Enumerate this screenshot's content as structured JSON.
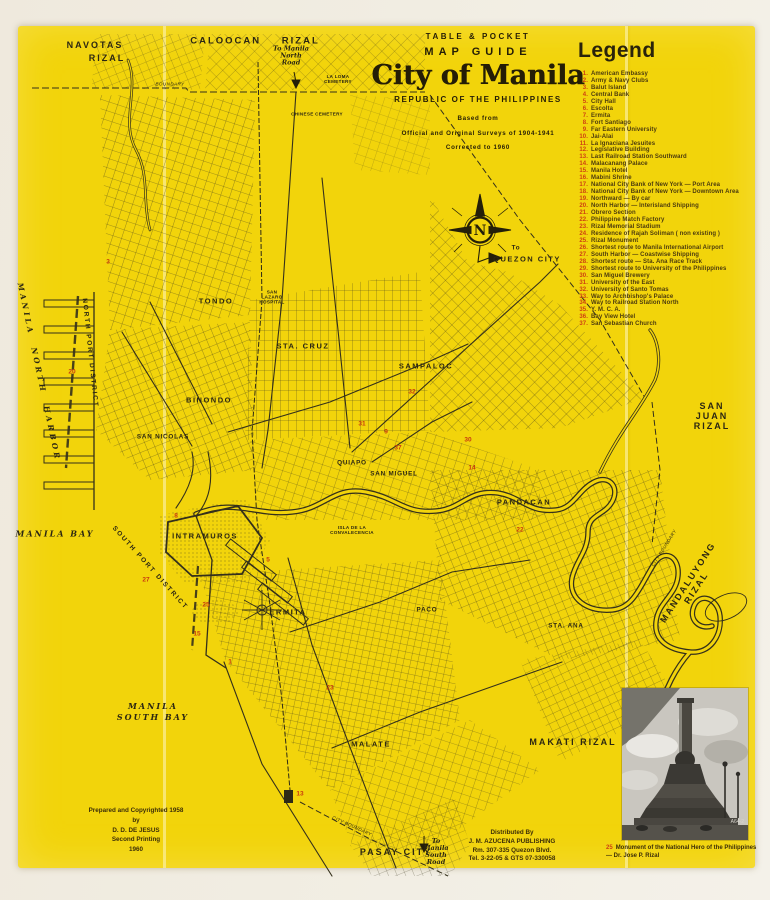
{
  "colors": {
    "sheet_yellow": "#f2d40b",
    "paper_cream": "#f1ede2",
    "ink": "#2c2712",
    "legend_number_red": "#ce4012",
    "marker_red": "#c83a10"
  },
  "title_block": {
    "line1": "TABLE & POCKET",
    "line2": "MAP GUIDE",
    "line3": "City of Manila",
    "line4": "REPUBLIC OF THE PHILIPPINES",
    "line5": "Based from",
    "line6": "Official and Original Surveys of 1904-1941",
    "line7": "Corrected to 1960"
  },
  "legend": {
    "heading": "Legend",
    "items": [
      {
        "n": "1",
        "t": "American Embassy"
      },
      {
        "n": "2",
        "t": "Army & Navy Clubs"
      },
      {
        "n": "3",
        "t": "Balut Island"
      },
      {
        "n": "4",
        "t": "Central Bank"
      },
      {
        "n": "5",
        "t": "City Hall"
      },
      {
        "n": "6",
        "t": "Escolta"
      },
      {
        "n": "7",
        "t": "Ermita"
      },
      {
        "n": "8",
        "t": "Fort Santiago"
      },
      {
        "n": "9",
        "t": "Far Eastern University"
      },
      {
        "n": "10",
        "t": "Jai-Alai"
      },
      {
        "n": "11",
        "t": "La Ignaciana Jesuites"
      },
      {
        "n": "12",
        "t": "Legislative Building"
      },
      {
        "n": "13",
        "t": "Last Railroad Station Southward"
      },
      {
        "n": "14",
        "t": "Malacanang Palace"
      },
      {
        "n": "15",
        "t": "Manila Hotel"
      },
      {
        "n": "16",
        "t": "Mabini Shrine"
      },
      {
        "n": "17",
        "t": "National City Bank of New York — Port Area"
      },
      {
        "n": "18",
        "t": "National City Bank of New York — Downtown Area"
      },
      {
        "n": "19",
        "t": "Northward — By car"
      },
      {
        "n": "20",
        "t": "North Harbor — Interisland Shipping"
      },
      {
        "n": "21",
        "t": "Obrero Section"
      },
      {
        "n": "22",
        "t": "Philippine Match Factory"
      },
      {
        "n": "23",
        "t": "Rizal Memorial Stadium"
      },
      {
        "n": "24",
        "t": "Residence of Rajah Soliman ( non existing )"
      },
      {
        "n": "25",
        "t": "Rizal Monument"
      },
      {
        "n": "26",
        "t": "Shortest route to Manila International Airport"
      },
      {
        "n": "27",
        "t": "South Harbor — Coastwise Shipping"
      },
      {
        "n": "28",
        "t": "Shortest route — Sta. Ana Race Track"
      },
      {
        "n": "29",
        "t": "Shortest route to University of the Philippines"
      },
      {
        "n": "30",
        "t": "San Miguel Brewery"
      },
      {
        "n": "31",
        "t": "University of the East"
      },
      {
        "n": "32",
        "t": "University of Santo Tomas"
      },
      {
        "n": "33",
        "t": "Way to Archbishop's Palace"
      },
      {
        "n": "34",
        "t": "Way to Railroad Station North"
      },
      {
        "n": "35",
        "t": "Y. M. C. A."
      },
      {
        "n": "36",
        "t": "Bay View Hotel"
      },
      {
        "n": "37",
        "t": "San Sebastian Church"
      }
    ]
  },
  "map": {
    "labels": [
      {
        "id": "label-navotas",
        "t": "NAVOTAS",
        "x": 95,
        "y": 45,
        "c": "town"
      },
      {
        "id": "label-navotas-rizal",
        "t": "RIZAL",
        "x": 107,
        "y": 58,
        "c": "town"
      },
      {
        "id": "label-caloocan-rizal",
        "t": "CALOOCAN RIZAL",
        "x": 255,
        "y": 41,
        "c": "townsp"
      },
      {
        "id": "label-to-manila-north-road",
        "t": "To Manila\nNorth\nRoad",
        "x": 291,
        "y": 56,
        "c": "script"
      },
      {
        "id": "label-boundary",
        "t": "BOUNDARY",
        "x": 170,
        "y": 84,
        "c": "tiny-it"
      },
      {
        "id": "label-la-loma-cemetery",
        "t": "LA LOMA\nCEMETERY",
        "x": 338,
        "y": 79,
        "c": "tinyl"
      },
      {
        "id": "label-chinese-cemetery",
        "t": "CHINESE CEMETERY",
        "x": 317,
        "y": 114,
        "c": "tinyl"
      },
      {
        "id": "label-to-quezon-city",
        "t": "To",
        "x": 516,
        "y": 248,
        "c": "dist-sm"
      },
      {
        "id": "label-quezon-city",
        "t": "QUEZON  CITY",
        "x": 527,
        "y": 259,
        "c": "dist"
      },
      {
        "id": "label-manila-north-harbor",
        "t": "MANILA  NORTH  HARBOR",
        "x": 39,
        "y": 372,
        "c": "harb",
        "r": 78
      },
      {
        "id": "label-north-port-district",
        "t": "NORTH  PORT  DISTRICT",
        "x": 90,
        "y": 353,
        "c": "port",
        "r": 84
      },
      {
        "id": "label-tondo",
        "t": "TONDO",
        "x": 216,
        "y": 301,
        "c": "dist"
      },
      {
        "id": "label-san-lazaro-hospital",
        "t": "SAN\nLAZARO\nHOSPITAL",
        "x": 272,
        "y": 297,
        "c": "tinyl"
      },
      {
        "id": "label-sta-cruz",
        "t": "STA. CRUZ",
        "x": 303,
        "y": 346,
        "c": "dist"
      },
      {
        "id": "label-sampaloc",
        "t": "SAMPALOC",
        "x": 426,
        "y": 366,
        "c": "dist"
      },
      {
        "id": "label-binondo",
        "t": "BINONDO",
        "x": 209,
        "y": 400,
        "c": "dist"
      },
      {
        "id": "label-san-nicolas",
        "t": "SAN NICOLAS",
        "x": 163,
        "y": 437,
        "c": "dist-sm"
      },
      {
        "id": "label-quiapo",
        "t": "QUIAPO",
        "x": 352,
        "y": 463,
        "c": "dist-sm"
      },
      {
        "id": "label-san-miguel",
        "t": "SAN MIGUEL",
        "x": 394,
        "y": 474,
        "c": "dist-sm"
      },
      {
        "id": "label-pandacan",
        "t": "PANDACAN",
        "x": 524,
        "y": 502,
        "c": "dist"
      },
      {
        "id": "label-isla-convalecencia",
        "t": "ISLA DE LA\nCONVALECENCIA",
        "x": 352,
        "y": 530,
        "c": "tinyl"
      },
      {
        "id": "label-intramuros",
        "t": "INTRAMUROS",
        "x": 205,
        "y": 536,
        "c": "dist"
      },
      {
        "id": "label-south-port-district",
        "t": "SOUTH  PORT  DISTRICT",
        "x": 150,
        "y": 568,
        "c": "port",
        "r": 48
      },
      {
        "id": "label-ermita",
        "t": "ERMITA",
        "x": 288,
        "y": 612,
        "c": "dist"
      },
      {
        "id": "label-paco",
        "t": "PACO",
        "x": 427,
        "y": 610,
        "c": "dist-sm"
      },
      {
        "id": "label-sta-ana",
        "t": "STA. ANA",
        "x": 566,
        "y": 626,
        "c": "dist-sm"
      },
      {
        "id": "label-san-juan-rizal",
        "t": "SAN JUAN RIZAL",
        "x": 712,
        "y": 416,
        "c": "town"
      },
      {
        "id": "label-city-boundary-e",
        "t": "CITY  BOUNDARY",
        "x": 664,
        "y": 548,
        "c": "tiny-it",
        "r": -58
      },
      {
        "id": "label-mandaluyong-rizal",
        "t": "MANDALUYONG  RIZAL",
        "x": 692,
        "y": 585,
        "c": "town",
        "r": -57
      },
      {
        "id": "label-makati-rizal",
        "t": "MAKATI RIZAL",
        "x": 573,
        "y": 742,
        "c": "town"
      },
      {
        "id": "label-malate",
        "t": "MALATE",
        "x": 371,
        "y": 744,
        "c": "dist"
      },
      {
        "id": "label-manila-bay",
        "t": "MANILA  BAY",
        "x": 55,
        "y": 534,
        "c": "bay"
      },
      {
        "id": "label-manila-south-bay",
        "t": "MANILA\nSOUTH  BAY",
        "x": 153,
        "y": 712,
        "c": "bay"
      },
      {
        "id": "label-pasay-city",
        "t": "PASAY  CITY",
        "x": 396,
        "y": 852,
        "c": "town"
      },
      {
        "id": "label-to-manila-south-road",
        "t": "To\nManila\nSouth\nRoad",
        "x": 436,
        "y": 852,
        "c": "script"
      },
      {
        "id": "label-city-boundary-s",
        "t": "CITY  BOUNDARY",
        "x": 352,
        "y": 826,
        "c": "tiny-it",
        "r": 24
      }
    ],
    "markers": [
      {
        "n": "3",
        "x": 108,
        "y": 262
      },
      {
        "n": "20",
        "x": 72,
        "y": 372
      },
      {
        "n": "31",
        "x": 362,
        "y": 424
      },
      {
        "n": "32",
        "x": 412,
        "y": 392
      },
      {
        "n": "9",
        "x": 386,
        "y": 432
      },
      {
        "n": "37",
        "x": 398,
        "y": 448
      },
      {
        "n": "14",
        "x": 472,
        "y": 468
      },
      {
        "n": "30",
        "x": 468,
        "y": 440
      },
      {
        "n": "22",
        "x": 520,
        "y": 530
      },
      {
        "n": "8",
        "x": 176,
        "y": 516
      },
      {
        "n": "5",
        "x": 268,
        "y": 560
      },
      {
        "n": "27",
        "x": 146,
        "y": 580
      },
      {
        "n": "25",
        "x": 206,
        "y": 605
      },
      {
        "n": "15",
        "x": 197,
        "y": 634
      },
      {
        "n": "1",
        "x": 230,
        "y": 662
      },
      {
        "n": "23",
        "x": 330,
        "y": 688
      },
      {
        "n": "13",
        "x": 300,
        "y": 794
      }
    ],
    "credits": {
      "lines": [
        "Prepared and Copyrighted 1958",
        "by",
        "D. D. DE JESUS",
        "Second Printing",
        "1960"
      ]
    },
    "distributor": {
      "lines": [
        "Distributed By",
        "J. M. AZUCENA PUBLISHING",
        "Rm. 307-335 Quezon Blvd.",
        "Tel. 3-22-05 & GTS 07-330058"
      ]
    },
    "photo_caption": {
      "num": "25",
      "text": "Monument of the National Hero of the Philippines — Dr. Jose P. Rizal"
    },
    "compass_letter": "N"
  }
}
